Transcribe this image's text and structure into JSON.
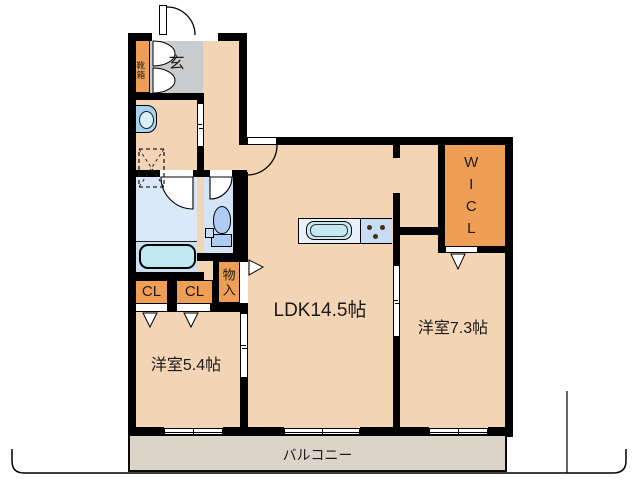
{
  "title": "apartment-floor-plan",
  "labels": {
    "entrance": "玄",
    "shoe_box": "靴箱",
    "ldk": "LDK14.5帖",
    "bedroom_east": "洋室7.3帖",
    "bedroom_west": "洋室5.4帖",
    "walk_in_closet": "WICL",
    "storage": "物入",
    "closet_a": "CL",
    "closet_b": "CL",
    "balcony": "バルコニー"
  },
  "colors": {
    "floor": "#F3D5B5",
    "entrance_floor": "#CACBCC",
    "closet_orange": "#EF9F55",
    "wall": "#000000",
    "bath_upper": "#D9E9F8",
    "bath_lower": "#CBDFF3",
    "bathtub": "#BFE7EE",
    "toilet_room": "#D3E4F7",
    "fixture_blue": "#AECCF1",
    "counter_sink": "#E9F1F9",
    "counter_stove": "#C8DDF3",
    "sink": "#C4E9F2",
    "basin": "#A6D3F0",
    "balcony": "#DCD4C8"
  }
}
